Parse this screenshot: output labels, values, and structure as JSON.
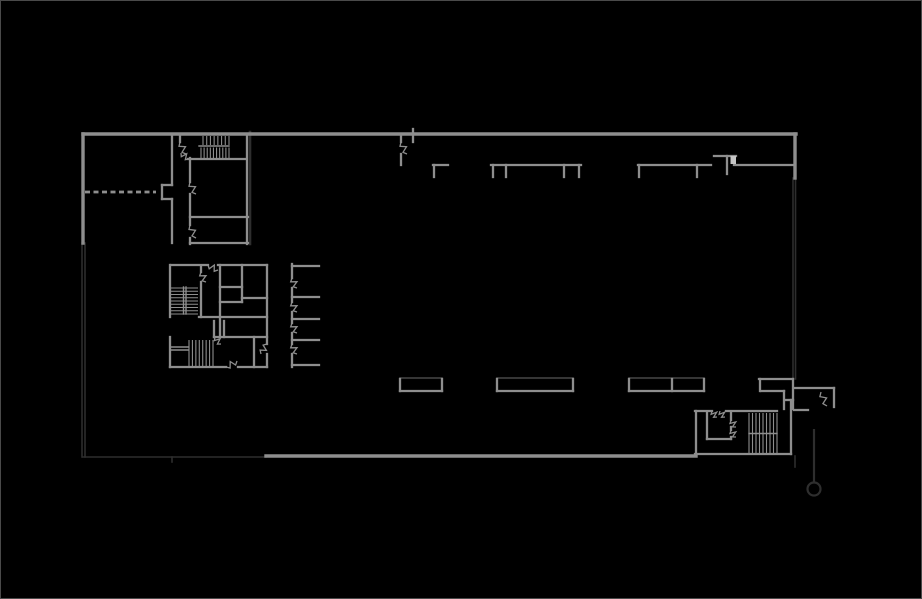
{
  "plan": {
    "colors": {
      "background": "#000000",
      "frame": "#4a4a4a",
      "wall_bright": "#8e8e8e",
      "wall_dim": "#2e2e2e",
      "panel_top_edge": "#474747",
      "light_block": "#c6c6c6"
    },
    "outline_bright": {
      "width": 3.4,
      "segs": [
        [
          82,
          133,
          795,
          133
        ],
        [
          82,
          133,
          82,
          242
        ],
        [
          794,
          133,
          794,
          177
        ],
        [
          265,
          455,
          695,
          455
        ]
      ]
    },
    "walls_interior": {
      "width": 2.3,
      "segs": [
        [
          171,
          133,
          171,
          184
        ],
        [
          161,
          184,
          171,
          184
        ],
        [
          161,
          184,
          161,
          198
        ],
        [
          161,
          198,
          171,
          198
        ],
        [
          171,
          198,
          171,
          242
        ],
        [
          179,
          133,
          179,
          141
        ],
        [
          187,
          158,
          245,
          158
        ],
        [
          189,
          157,
          189,
          181
        ],
        [
          189,
          193,
          189,
          224
        ],
        [
          189,
          237,
          189,
          243
        ],
        [
          189,
          216,
          247,
          216
        ],
        [
          189,
          242,
          247,
          242
        ],
        [
          246,
          133,
          246,
          243
        ],
        [
          400,
          134,
          400,
          141
        ],
        [
          400,
          153,
          400,
          164
        ],
        [
          412,
          128,
          412,
          141
        ],
        [
          432,
          164,
          447,
          164
        ],
        [
          433,
          164,
          433,
          176
        ],
        [
          490,
          164,
          580,
          164
        ],
        [
          492,
          164,
          492,
          176
        ],
        [
          505,
          164,
          505,
          176
        ],
        [
          563,
          164,
          563,
          176
        ],
        [
          578,
          164,
          578,
          176
        ],
        [
          637,
          164,
          710,
          164
        ],
        [
          638,
          164,
          638,
          176
        ],
        [
          696,
          164,
          696,
          176
        ],
        [
          713,
          155,
          735,
          155
        ],
        [
          726,
          155,
          726,
          173
        ],
        [
          733,
          164,
          792,
          164
        ],
        [
          170,
          264,
          207,
          264
        ],
        [
          217,
          264,
          266,
          264
        ],
        [
          169,
          264,
          169,
          316
        ],
        [
          169,
          336,
          169,
          366
        ],
        [
          169,
          366,
          225,
          366
        ],
        [
          237,
          366,
          266,
          366
        ],
        [
          266,
          264,
          266,
          343
        ],
        [
          266,
          353,
          266,
          366
        ],
        [
          200,
          265,
          200,
          271
        ],
        [
          200,
          281,
          200,
          316
        ],
        [
          219,
          264,
          219,
          336
        ],
        [
          241,
          264,
          241,
          301
        ],
        [
          219,
          286,
          241,
          286
        ],
        [
          241,
          297,
          266,
          297
        ],
        [
          219,
          301,
          241,
          301
        ],
        [
          198,
          316,
          266,
          316
        ],
        [
          213,
          320,
          213,
          336
        ],
        [
          223,
          320,
          223,
          336
        ],
        [
          213,
          336,
          266,
          336
        ],
        [
          253,
          336,
          253,
          366
        ],
        [
          291,
          263,
          291,
          277
        ],
        [
          291,
          287,
          291,
          301
        ],
        [
          291,
          311,
          291,
          322
        ],
        [
          291,
          332,
          291,
          343
        ],
        [
          291,
          353,
          291,
          366
        ],
        [
          291,
          265,
          318,
          265
        ],
        [
          291,
          296,
          318,
          296
        ],
        [
          291,
          318,
          318,
          318
        ],
        [
          291,
          339,
          318,
          339
        ],
        [
          291,
          364,
          318,
          364
        ],
        [
          399,
          378,
          399,
          390
        ],
        [
          399,
          390,
          441,
          390
        ],
        [
          441,
          378,
          441,
          390
        ],
        [
          496,
          378,
          496,
          390
        ],
        [
          496,
          390,
          572,
          390
        ],
        [
          572,
          378,
          572,
          390
        ],
        [
          628,
          378,
          628,
          390
        ],
        [
          628,
          390,
          703,
          390
        ],
        [
          703,
          378,
          703,
          390
        ],
        [
          671,
          378,
          671,
          390
        ],
        [
          758,
          378,
          792,
          378
        ],
        [
          759,
          378,
          759,
          390
        ],
        [
          760,
          390,
          783,
          390
        ],
        [
          783,
          390,
          783,
          408
        ],
        [
          784,
          399,
          792,
          399
        ],
        [
          792,
          378,
          792,
          408
        ],
        [
          694,
          410,
          711,
          410
        ],
        [
          725,
          410,
          776,
          410
        ],
        [
          695,
          410,
          695,
          453
        ],
        [
          706,
          412,
          706,
          438
        ],
        [
          706,
          438,
          730,
          438
        ],
        [
          730,
          412,
          730,
          419
        ],
        [
          730,
          426,
          730,
          429
        ],
        [
          730,
          436,
          730,
          438
        ],
        [
          790,
          399,
          790,
          453
        ],
        [
          694,
          453,
          790,
          453
        ],
        [
          794,
          387,
          833,
          387
        ],
        [
          833,
          387,
          833,
          406
        ],
        [
          793,
          409,
          807,
          409
        ]
      ]
    },
    "walls_dim": {
      "width": 1.6,
      "segs": [
        [
          81,
          242,
          81,
          456
        ],
        [
          84,
          242,
          84,
          456
        ],
        [
          82,
          456,
          265,
          456
        ],
        [
          792,
          177,
          792,
          378
        ],
        [
          794.5,
          177,
          794.5,
          378
        ],
        [
          794,
          455,
          794,
          466
        ],
        [
          171,
          456,
          171,
          461
        ]
      ]
    },
    "block_shadow": {
      "width": 2.6,
      "segs": [
        [
          249,
          131,
          249,
          243
        ]
      ]
    },
    "panel_top_edges": {
      "width": 1.5,
      "segs": [
        [
          399,
          377,
          441,
          377
        ],
        [
          496,
          377,
          572,
          377
        ],
        [
          628,
          377,
          703,
          377
        ]
      ]
    },
    "stair_rails": {
      "width": 1.4,
      "segs": [
        [
          198,
          145,
          228,
          145
        ],
        [
          182.5,
          286,
          182.5,
          313
        ],
        [
          185,
          286,
          185,
          313
        ],
        [
          170,
          346,
          187,
          346
        ],
        [
          170,
          349,
          187,
          349
        ],
        [
          748,
          432.5,
          776,
          432.5
        ]
      ]
    },
    "stairs": [
      {
        "dir": "v",
        "x0": 202,
        "x1": 228,
        "y0": 135,
        "y1": 144,
        "n": 8
      },
      {
        "dir": "v",
        "x0": 200,
        "x1": 228,
        "y0": 146.5,
        "y1": 157,
        "n": 10
      },
      {
        "dir": "h",
        "x0": 170,
        "x1": 197,
        "y0": 287,
        "y1": 313,
        "n": 9
      },
      {
        "dir": "v",
        "x0": 188,
        "x1": 212,
        "y0": 339,
        "y1": 366,
        "n": 8
      },
      {
        "dir": "v",
        "x0": 748,
        "x1": 776,
        "y0": 412,
        "y1": 452,
        "n": 9
      }
    ],
    "doors": [
      [
        179,
        141,
        185,
        153
      ],
      [
        180,
        152,
        188,
        158
      ],
      [
        189,
        181,
        195,
        193
      ],
      [
        189,
        224,
        195,
        237
      ],
      [
        400,
        141,
        406,
        153
      ],
      [
        207,
        264,
        217,
        269
      ],
      [
        200,
        271,
        205,
        281
      ],
      [
        225,
        366,
        236,
        360
      ],
      [
        266,
        343,
        260,
        353
      ],
      [
        214,
        336,
        220,
        343
      ],
      [
        291,
        277,
        296,
        287
      ],
      [
        291,
        301,
        296,
        311
      ],
      [
        291,
        322,
        296,
        332
      ],
      [
        291,
        343,
        296,
        353
      ],
      [
        711,
        410,
        716,
        416
      ],
      [
        719,
        410,
        724,
        416
      ],
      [
        730,
        419,
        735,
        426
      ],
      [
        730,
        429,
        735,
        436
      ],
      [
        820,
        391,
        826,
        405
      ]
    ],
    "dashed_opening": {
      "seg": [
        84,
        191,
        155,
        191
      ],
      "pattern": "5,3.5",
      "width": 2.8
    },
    "light_block": {
      "x": 729.5,
      "y": 155,
      "w": 5.5,
      "h": 8
    },
    "marker": {
      "leader": [
        813,
        428,
        813,
        481
      ],
      "cx": 813,
      "cy": 488,
      "r": 6.5,
      "width": 2.2
    }
  }
}
